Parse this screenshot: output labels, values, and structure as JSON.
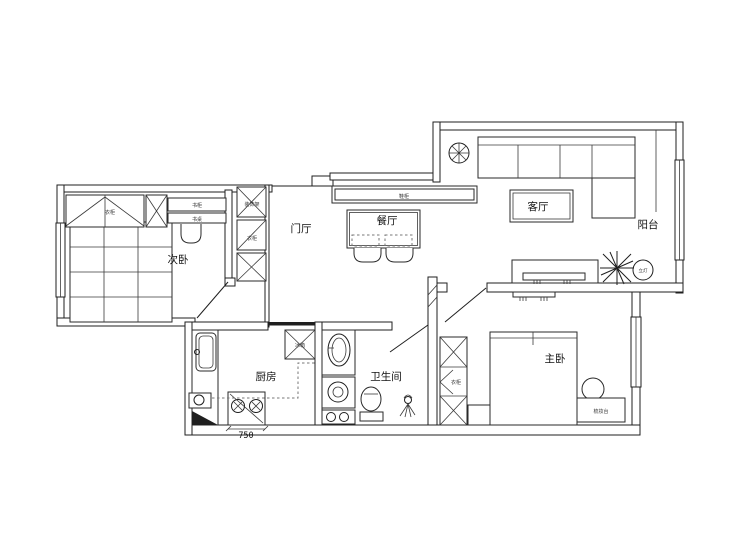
{
  "plan": {
    "rooms": {
      "secondary_bedroom": "次卧",
      "entrance_hall": "门厅",
      "dining_room": "餐厅",
      "living_room": "客厅",
      "balcony": "阳台",
      "kitchen": "厨房",
      "bathroom": "卫生间",
      "master_bedroom": "主卧"
    },
    "furniture": {
      "bedroom_wardrobe": "衣柜",
      "bookcase": "书柜",
      "desk": "书桌",
      "hall_cabinet_top": "装饰架",
      "hall_cabinet_mid": "衣柜",
      "shoe_cabinet": "鞋柜",
      "fridge": "冰箱",
      "master_wardrobe": "衣柜",
      "dressing_table": "梳妆台",
      "floor_lamp": "立灯"
    },
    "dimensions": {
      "stove_width": "750"
    },
    "colors": {
      "line": "#1f1f1f",
      "background": "#ffffff"
    }
  }
}
